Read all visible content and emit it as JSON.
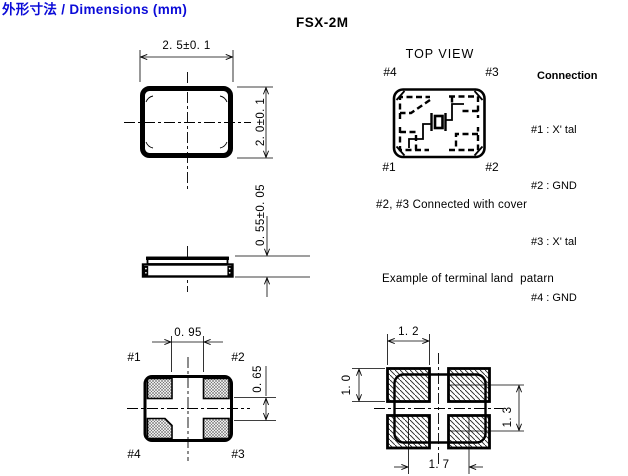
{
  "page": {
    "title": "外形寸法 / Dimensions (mm)",
    "part_number": "FSX-2M"
  },
  "front_view": {
    "width_dim": "2. 5±0. 1",
    "height_dim": "2. 0±0. 1"
  },
  "side_view": {
    "thickness_dim": "0. 55±0. 05"
  },
  "top_view": {
    "label": "TOP VIEW",
    "pad_top_left": "#4",
    "pad_top_right": "#3",
    "pad_bottom_left": "#1",
    "pad_bottom_right": "#2"
  },
  "connection": {
    "heading": "Connection",
    "lines": [
      "#1 : X' tal",
      "#2 : GND",
      "#3 : X' tal",
      "#4 : GND"
    ]
  },
  "notes": {
    "cover": "#2, #3 Connected with cover",
    "land_pattern": "Example of terminal land  patarn"
  },
  "bottom_view": {
    "pad_top_left": "#1",
    "pad_top_right": "#2",
    "pad_bottom_left": "#4",
    "pad_bottom_right": "#3",
    "gap_x_dim": "0. 95",
    "gap_y_dim": "0. 65"
  },
  "land_pattern": {
    "pad_width_dim": "1. 2",
    "pad_height_dim": "1. 0",
    "pitch_y_dim": "1. 3",
    "pitch_x_dim": "1. 7"
  },
  "colors": {
    "title_blue": "#0b0bd8",
    "line_black": "#000000"
  }
}
